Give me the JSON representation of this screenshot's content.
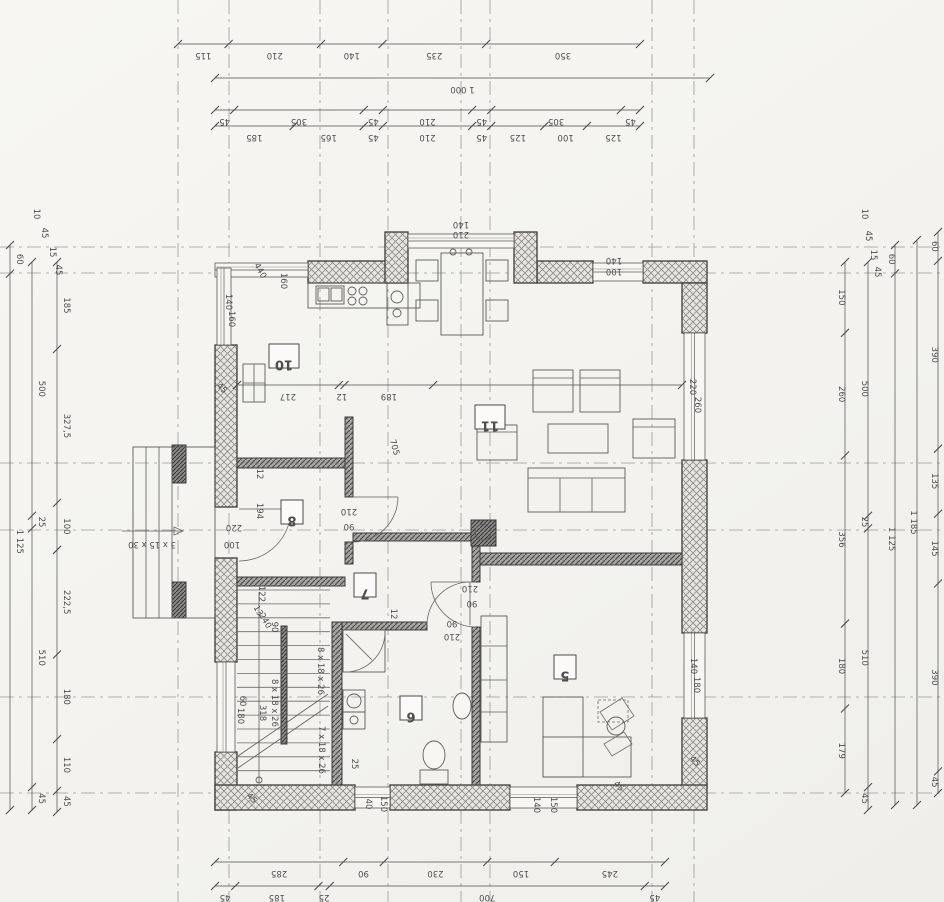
{
  "meta": {
    "document_type": "floor-plan",
    "orientation_note": "drawing appears rotated 180 degrees",
    "paper_color": "#f5f4f1",
    "ink_color": "#3c3c3c",
    "dim_color": "#4c4c4c",
    "hatch_ext_bg": "#e7e5e0",
    "hatch_int_bg": "#a8a6a2"
  },
  "rooms": [
    {
      "n": "10",
      "x": 269,
      "y": 344,
      "w": 30,
      "h": 24
    },
    {
      "n": "11",
      "x": 475,
      "y": 405,
      "w": 30,
      "h": 24
    },
    {
      "n": "8",
      "x": 281,
      "y": 500,
      "w": 22,
      "h": 24
    },
    {
      "n": "7",
      "x": 354,
      "y": 573,
      "w": 22,
      "h": 24
    },
    {
      "n": "6",
      "x": 400,
      "y": 696,
      "w": 22,
      "h": 24
    },
    {
      "n": "5",
      "x": 554,
      "y": 655,
      "w": 22,
      "h": 24
    }
  ],
  "chains": [
    {
      "dir": "h",
      "y": 44,
      "x1": 178,
      "x2": 640,
      "vals": [
        "115",
        "210",
        "140",
        "235",
        "350"
      ]
    },
    {
      "dir": "h",
      "y": 78,
      "x1": 215,
      "x2": 710,
      "vals": [
        "1 000"
      ]
    },
    {
      "dir": "h",
      "y": 110,
      "x1": 215,
      "x2": 640,
      "vals": [
        "45",
        "305",
        "45",
        "210",
        "45",
        "305",
        "45"
      ]
    },
    {
      "dir": "h",
      "y": 126,
      "x1": 215,
      "x2": 640,
      "vals": [
        "185",
        "165",
        "45",
        "210",
        "45",
        "125",
        "100",
        "125"
      ]
    },
    {
      "dir": "h",
      "y": 385,
      "x1": 237,
      "x2": 682,
      "vals": [
        "217",
        "12",
        "189",
        [
          "",
          530
        ]
      ]
    },
    {
      "dir": "h",
      "y": 862,
      "x1": 215,
      "x2": 665,
      "vals": [
        "285",
        "90",
        "230",
        "150",
        "245"
      ]
    },
    {
      "dir": "h",
      "y": 886,
      "x1": 215,
      "x2": 665,
      "vals": [
        "45",
        "185",
        "25",
        "700",
        "45"
      ]
    },
    {
      "dir": "v",
      "x": 57,
      "y1": 262,
      "y2": 812,
      "vals": [
        "185",
        "327,5",
        "100",
        "222,5",
        "180",
        "110",
        "45"
      ]
    },
    {
      "dir": "v",
      "x": 32,
      "y1": 262,
      "y2": 810,
      "vals": [
        "500",
        "25",
        "510",
        "45"
      ]
    },
    {
      "dir": "v",
      "x": 10,
      "y1": 245,
      "y2": 810,
      "vals": [
        "60",
        "1 125"
      ]
    },
    {
      "dir": "v",
      "x": 845,
      "y1": 262,
      "y2": 793,
      "vals": [
        "150",
        "260",
        "356",
        "180",
        "179"
      ]
    },
    {
      "dir": "v",
      "x": 868,
      "y1": 262,
      "y2": 810,
      "vals": [
        "500",
        "25",
        "510",
        "45"
      ]
    },
    {
      "dir": "v",
      "x": 895,
      "y1": 245,
      "y2": 805,
      "vals": [
        "60",
        "1 125"
      ]
    },
    {
      "dir": "v",
      "x": 917,
      "y1": 240,
      "y2": 805,
      "vals": [
        "1 185"
      ]
    },
    {
      "dir": "v",
      "x": 938,
      "y1": 232,
      "y2": 793,
      "vals": [
        "60",
        "390",
        "135",
        "145",
        "390",
        "45"
      ]
    }
  ],
  "labels": [
    [
      "140",
      461,
      222,
      180
    ],
    [
      "210",
      461,
      232,
      180
    ],
    [
      "140",
      614,
      258,
      180
    ],
    [
      "100",
      614,
      269,
      180
    ],
    [
      "440",
      258,
      272,
      60
    ],
    [
      "160",
      281,
      281,
      90
    ],
    [
      "140",
      226,
      302,
      90
    ],
    [
      "160",
      229,
      319,
      90
    ],
    [
      "220",
      690,
      387,
      90
    ],
    [
      "260",
      695,
      405,
      90
    ],
    [
      "140",
      691,
      666,
      90
    ],
    [
      "180",
      694,
      685,
      90
    ],
    [
      "60",
      240,
      701,
      90
    ],
    [
      "180",
      238,
      716,
      90
    ],
    [
      "140",
      534,
      805,
      90
    ],
    [
      "150",
      551,
      805,
      90
    ],
    [
      "40",
      366,
      804,
      90
    ],
    [
      "150",
      381,
      804,
      90
    ],
    [
      "220",
      234,
      525,
      180
    ],
    [
      "100",
      232,
      542,
      180
    ],
    [
      "210",
      349,
      509,
      180
    ],
    [
      "90",
      349,
      524,
      180
    ],
    [
      "210",
      470,
      586,
      180
    ],
    [
      "90",
      472,
      601,
      180
    ],
    [
      "90",
      452,
      621,
      180
    ],
    [
      "210",
      452,
      634,
      180
    ],
    [
      "194",
      257,
      511,
      90
    ],
    [
      "12",
      257,
      474,
      90
    ],
    [
      "122",
      259,
      594,
      90
    ],
    [
      "13",
      256,
      612,
      60
    ],
    [
      "240",
      263,
      622,
      60
    ],
    [
      "90",
      272,
      627,
      90
    ],
    [
      "318",
      260,
      713,
      90
    ],
    [
      "8 x 18 x 26",
      272,
      703,
      90
    ],
    [
      "8 x 18 x 26",
      318,
      671,
      90
    ],
    [
      "7 x 18 x 26",
      319,
      750,
      90
    ],
    [
      "3 x 15 x 30",
      152,
      542,
      180
    ],
    [
      "705",
      392,
      448,
      75
    ],
    [
      "12",
      391,
      614,
      90
    ],
    [
      "45",
      220,
      390,
      45
    ],
    [
      "45",
      693,
      763,
      45
    ],
    [
      "45",
      617,
      788,
      45
    ],
    [
      "45",
      250,
      800,
      45
    ],
    [
      "25",
      352,
      764,
      90
    ],
    [
      "10",
      34,
      214,
      90
    ],
    [
      "45",
      42,
      233,
      90
    ],
    [
      "15",
      50,
      252,
      90
    ],
    [
      "45",
      56,
      270,
      90
    ],
    [
      "10",
      862,
      214,
      90
    ],
    [
      "45",
      866,
      236,
      90
    ],
    [
      "15",
      871,
      255,
      90
    ],
    [
      "45",
      875,
      272,
      90
    ]
  ],
  "axes": {
    "vertical": [
      178,
      229,
      320,
      388,
      461,
      490,
      652,
      694
    ],
    "horizontal": [
      247,
      273,
      463,
      530,
      697,
      793
    ]
  },
  "plan": {
    "walls_ext": [
      [
        308,
        261,
        99,
        22
      ],
      [
        537,
        261,
        56,
        22
      ],
      [
        643,
        261,
        64,
        22
      ],
      [
        682,
        283,
        25,
        50
      ],
      [
        682,
        460,
        25,
        173
      ],
      [
        682,
        718,
        25,
        70
      ],
      [
        215,
        345,
        22,
        162
      ],
      [
        215,
        558,
        22,
        104
      ],
      [
        215,
        752,
        22,
        58
      ],
      [
        215,
        785,
        140,
        25
      ],
      [
        390,
        785,
        120,
        25
      ],
      [
        577,
        785,
        130,
        25
      ],
      [
        385,
        232,
        23,
        51
      ],
      [
        514,
        232,
        23,
        51
      ]
    ],
    "walls_int": [
      [
        237,
        458,
        116,
        10
      ],
      [
        345,
        417,
        8,
        80
      ],
      [
        345,
        542,
        8,
        22
      ],
      [
        237,
        577,
        108,
        9
      ],
      [
        353,
        533,
        119,
        8
      ],
      [
        472,
        541,
        8,
        41
      ],
      [
        472,
        627,
        8,
        158
      ],
      [
        480,
        553,
        202,
        12
      ],
      [
        332,
        622,
        10,
        163
      ],
      [
        342,
        622,
        85,
        8
      ]
    ],
    "walls_dark": [
      [
        281,
        626,
        6,
        118
      ],
      [
        172,
        445,
        14,
        38
      ],
      [
        172,
        582,
        14,
        36
      ],
      [
        471,
        520,
        25,
        26
      ]
    ],
    "windows": [
      [
        215,
        263,
        93,
        14,
        "h"
      ],
      [
        217,
        268,
        14,
        77,
        "v"
      ],
      [
        408,
        234,
        106,
        14,
        "h"
      ],
      [
        593,
        263,
        50,
        18,
        "h"
      ],
      [
        684,
        333,
        21,
        127,
        "v"
      ],
      [
        684,
        633,
        21,
        85,
        "v"
      ],
      [
        217,
        662,
        18,
        90,
        "v"
      ],
      [
        355,
        787,
        35,
        21,
        "h"
      ],
      [
        510,
        787,
        67,
        21,
        "h"
      ]
    ],
    "furniture_rects": [
      [
        441,
        253,
        42,
        82
      ],
      [
        416,
        260,
        22,
        21
      ],
      [
        416,
        300,
        22,
        21
      ],
      [
        486,
        260,
        22,
        21
      ],
      [
        486,
        300,
        22,
        21
      ],
      [
        308,
        283,
        112,
        25
      ],
      [
        316,
        286,
        28,
        18
      ],
      [
        318,
        288,
        11,
        13
      ],
      [
        331,
        288,
        11,
        13
      ],
      [
        387,
        283,
        21,
        42
      ],
      [
        243,
        364,
        22,
        38
      ],
      [
        533,
        370,
        40,
        42
      ],
      [
        580,
        370,
        40,
        42
      ],
      [
        477,
        425,
        40,
        35
      ],
      [
        548,
        424,
        60,
        29
      ],
      [
        633,
        419,
        42,
        39
      ],
      [
        528,
        468,
        97,
        44
      ],
      [
        481,
        616,
        26,
        126
      ],
      [
        343,
        690,
        22,
        22
      ],
      [
        343,
        712,
        22,
        17
      ],
      [
        343,
        630,
        42,
        42
      ],
      [
        420,
        770,
        28,
        14
      ],
      [
        543,
        697,
        40,
        80
      ],
      [
        543,
        737,
        88,
        40
      ],
      [
        133,
        447,
        82,
        171
      ]
    ],
    "dashed_rects": [
      [
        598,
        700,
        30,
        22
      ]
    ],
    "furniture_lines": [
      [
        528,
        478,
        625,
        478
      ],
      [
        560,
        478,
        560,
        512
      ],
      [
        592,
        478,
        592,
        512
      ],
      [
        533,
        378,
        573,
        378
      ],
      [
        580,
        378,
        620,
        378
      ],
      [
        477,
        432,
        517,
        432
      ],
      [
        633,
        427,
        675,
        427
      ],
      [
        481,
        646,
        507,
        646
      ],
      [
        481,
        680,
        507,
        680
      ],
      [
        481,
        712,
        507,
        712
      ],
      [
        254,
        364,
        254,
        402
      ],
      [
        243,
        383,
        265,
        383
      ],
      [
        346,
        634,
        372,
        660
      ],
      [
        146,
        447,
        146,
        618
      ],
      [
        159,
        447,
        159,
        618
      ],
      [
        172,
        447,
        172,
        618
      ],
      [
        238,
        756,
        328,
        694
      ],
      [
        238,
        768,
        328,
        706
      ],
      [
        259,
        592,
        259,
        783
      ],
      [
        122,
        531,
        183,
        531
      ],
      [
        239,
        509,
        291,
        509
      ],
      [
        353,
        497,
        398,
        497
      ],
      [
        476,
        582,
        431,
        582
      ],
      [
        470,
        625,
        470,
        582
      ]
    ],
    "circles": [
      [
        352,
        291,
        4
      ],
      [
        363,
        291,
        4
      ],
      [
        352,
        301,
        4
      ],
      [
        363,
        301,
        4
      ],
      [
        397,
        297,
        6
      ],
      [
        397,
        313,
        4
      ],
      [
        354,
        701,
        7
      ],
      [
        354,
        720,
        4
      ],
      [
        453,
        252,
        3
      ],
      [
        469,
        252,
        3
      ],
      [
        616,
        726,
        9
      ],
      [
        483,
        532,
        8
      ],
      [
        259,
        780,
        3
      ]
    ],
    "ellipses": [
      [
        434,
        755,
        11,
        14
      ],
      [
        462,
        706,
        9,
        13
      ]
    ],
    "paths": [
      "M385,632 A40,40 0 0 1 345,672",
      "M291,509 A52,52 0 0 1 239,561",
      "M398,497 A45,45 0 0 1 353,542",
      "M431,582 A45,45 0 0 0 476,627",
      "M427,625 A43,43 0 0 1 470,582",
      "M600,712 l22,-14 l12,18 l-22,14 Z",
      "M604,744 l20,-12 l8,12 l-20,12 Z",
      "M183,531 l-9,-4 l0,8 Z"
    ],
    "stairs": {
      "x1": 237,
      "x2": 330,
      "y_start": 590,
      "count": 14,
      "dy": 13.9
    }
  }
}
